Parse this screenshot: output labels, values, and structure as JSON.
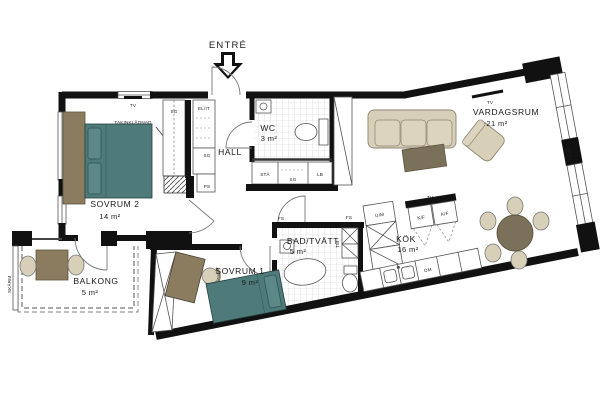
{
  "plan": {
    "entry_label": "ENTRÉ",
    "rooms": {
      "vardagsrum": {
        "name": "VARDAGSRUM",
        "area": "21 m²"
      },
      "sovrum2": {
        "name": "SOVRUM 2",
        "area": "14 m²"
      },
      "sovrum1": {
        "name": "SOVRUM 1",
        "area": "9 m²"
      },
      "kok": {
        "name": "KÖK",
        "area": "16 m²"
      },
      "bad": {
        "name": "BAD/TVÄTT",
        "area": "5 m²"
      },
      "wc": {
        "name": "WC",
        "area": "3 m²"
      },
      "balkong": {
        "name": "BALKONG",
        "area": "5 m²"
      },
      "hall": {
        "name": "HALL"
      }
    },
    "annotations": {
      "tv": "TV",
      "takinkladnad": "TAKINKLÄDNAD",
      "sg": "SG",
      "elit": "EL/IT",
      "ps": "PS",
      "fs": "FS",
      "sta": "STÄ",
      "lb": "LB",
      "kf": "K/F",
      "um": "U/M",
      "dm": "DM",
      "tm": "TM",
      "skarm": "SKÄRM",
      "br90": "BR 90"
    },
    "colors": {
      "wall": "#111111",
      "bed": "#4f7a7a",
      "bed_light": "#5d8888",
      "wood": "#8b7c5f",
      "fabric": "#d8cfb8",
      "table": "#7b705a"
    }
  }
}
